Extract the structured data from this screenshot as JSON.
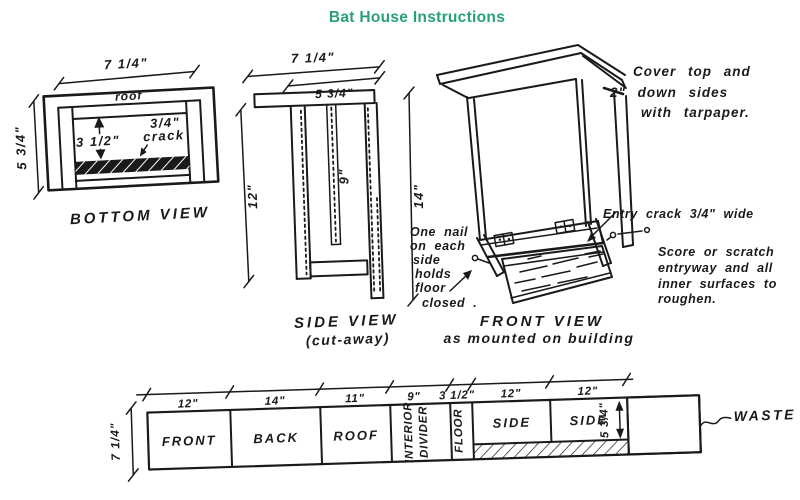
{
  "title": "Bat House Instructions",
  "colors": {
    "title_green": "#28a179",
    "ink": "#1a1a1a",
    "paper": "#ffffff"
  },
  "bottom_view": {
    "caption": "BOTTOM VIEW",
    "roof_label": "roof",
    "width_dim": "7 1/4\"",
    "height_dim": "5 3/4\"",
    "cavity_dim": "3 1/2\"",
    "crack_dim_line1": "3/4\"",
    "crack_dim_line2": "crack"
  },
  "side_view": {
    "caption_line1": "SIDE VIEW",
    "caption_line2": "(cut-away)",
    "width_dim": "7 1/4\"",
    "inner_width_dim": "5 3/4\"",
    "height_dim": "12\"",
    "divider_dim": "9\""
  },
  "front_view": {
    "caption_line1": "FRONT VIEW",
    "caption_line2": "as mounted on building",
    "height_dim": "14\"",
    "tarpaper_note": [
      "Cover top and",
      "2\" down sides",
      "with tarpaper."
    ],
    "nail_note": [
      "One nail",
      "on each",
      "side",
      "holds",
      "floor",
      "closed ."
    ],
    "entry_note": "Entry crack 3/4\" wide",
    "score_note": [
      "Score or scratch",
      "entryway and all",
      "inner surfaces to",
      "roughen."
    ]
  },
  "cutting_layout": {
    "height_dim": "7 1/4\"",
    "side_height_dim": "5 3/4\"",
    "waste_label": "WASTE",
    "segments": [
      {
        "width_dim": "12\"",
        "label": "FRONT"
      },
      {
        "width_dim": "14\"",
        "label": "BACK"
      },
      {
        "width_dim": "11\"",
        "label": "ROOF"
      },
      {
        "width_dim": "9\"",
        "label_lines": [
          "INTERIOR",
          "DIVIDER"
        ]
      },
      {
        "width_dim": "3 1/2\"",
        "label": "FLOOR"
      },
      {
        "width_dim": "12\"",
        "label": "SIDE"
      },
      {
        "width_dim": "12\"",
        "label": "SIDE"
      }
    ]
  }
}
